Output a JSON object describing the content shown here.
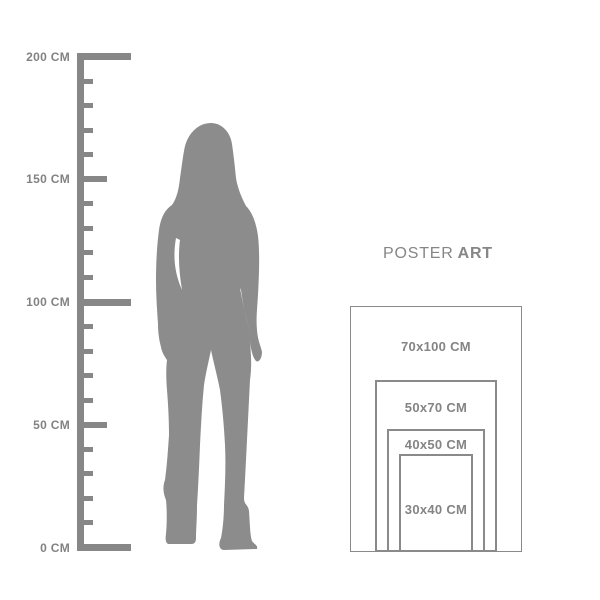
{
  "colors": {
    "gray": "#878787",
    "silhouette": "#8c8c8c",
    "border": "#8a8a8a",
    "text": "#828282",
    "background": "#ffffff"
  },
  "ruler": {
    "unit": "CM",
    "max_cm": 200,
    "minor_step_cm": 10,
    "labels": [
      {
        "cm": 200,
        "label": "200 CM"
      },
      {
        "cm": 150,
        "label": "150 CM"
      },
      {
        "cm": 100,
        "label": "100 CM"
      },
      {
        "cm": 50,
        "label": "50 CM"
      },
      {
        "cm": 0,
        "label": "0 CM"
      }
    ]
  },
  "figure": {
    "description": "standing woman silhouette with long hair and boots"
  },
  "poster_guide": {
    "title_regular": "POSTER",
    "title_bold": "ART",
    "sizes": [
      {
        "label": "70x100 CM",
        "width_cm": 70,
        "height_cm": 100
      },
      {
        "label": "50x70 CM",
        "width_cm": 50,
        "height_cm": 70
      },
      {
        "label": "40x50 CM",
        "width_cm": 40,
        "height_cm": 50
      },
      {
        "label": "30x40 CM",
        "width_cm": 30,
        "height_cm": 40
      }
    ]
  }
}
